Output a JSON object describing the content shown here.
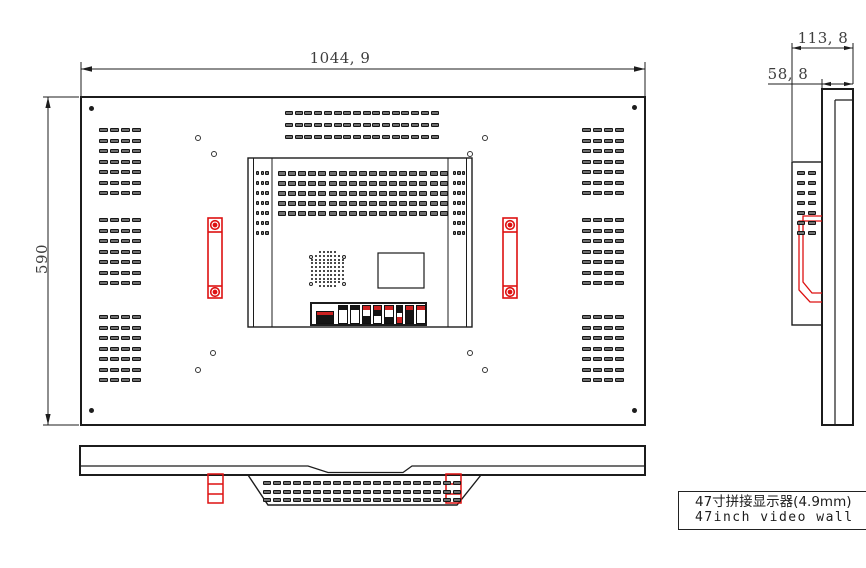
{
  "labels": {
    "dim_width": "1044, 9",
    "dim_height": "590",
    "dim_depth_total": "113, 8",
    "dim_depth_panel": "58, 8",
    "title_cn": "47寸拼接显示器(4.9mm)",
    "title_en": "47inch video wall"
  },
  "colors": {
    "line": "#1c1c1c",
    "red": "#dd1111",
    "dim_text": "#3e3e3e",
    "slot_fill": "#6f6f6f",
    "background": "#ffffff"
  },
  "slot_grids": [
    {
      "name": "rear-left-vents",
      "x": 99,
      "groupYs": [
        128,
        218,
        315
      ],
      "rows": 7,
      "cols": 4,
      "pitchX": 11,
      "pitchY": 10.5,
      "w": 9,
      "h": 4
    },
    {
      "name": "rear-right-vents",
      "x": 582,
      "groupYs": [
        128,
        218,
        315
      ],
      "rows": 7,
      "cols": 4,
      "pitchX": 11,
      "pitchY": 10.5,
      "w": 9,
      "h": 4
    },
    {
      "name": "rear-top-center-vents",
      "x": 285,
      "groupYs": [
        111
      ],
      "rows": 3,
      "cols": 16,
      "pitchX": 9.7,
      "pitchY": 12,
      "w": 8,
      "h": 4
    },
    {
      "name": "module-vent-rows",
      "x": 278,
      "groupYs": [
        171
      ],
      "rows": 5,
      "cols": 17,
      "pitchX": 10.1,
      "pitchY": 10,
      "w": 8,
      "h": 5
    },
    {
      "name": "module-strip-left",
      "x": 256,
      "groupYs": [
        171
      ],
      "rows": 7,
      "cols": 3,
      "pitchX": 4.7,
      "pitchY": 10,
      "w": 3.4,
      "h": 4
    },
    {
      "name": "module-strip-right",
      "x": 452.5,
      "groupYs": [
        171
      ],
      "rows": 7,
      "cols": 3,
      "pitchX": 4.7,
      "pitchY": 10,
      "w": 3.4,
      "h": 4
    },
    {
      "name": "side-enclosure-vents",
      "x": 797,
      "groupYs": [
        171
      ],
      "rows": 7,
      "cols": 2,
      "pitchX": 11,
      "pitchY": 10,
      "w": 8,
      "h": 4
    },
    {
      "name": "bottom-trapezoid-vents",
      "x": 263,
      "groupYs": [
        481
      ],
      "rows": 3,
      "cols": 20,
      "pitchX": 10,
      "pitchY": 8.5,
      "w": 7.5,
      "h": 4
    }
  ],
  "speaker": {
    "cx": 327.5,
    "top": 252,
    "pitch": 3.8,
    "dot": 2,
    "rowCols": [
      5,
      7,
      9,
      9,
      9,
      9,
      9,
      9,
      7,
      5
    ]
  },
  "speaker_rings": [
    [
      311,
      257
    ],
    [
      344,
      257
    ],
    [
      311,
      284
    ],
    [
      344,
      284
    ]
  ],
  "screw_dots": [
    [
      91,
      108
    ],
    [
      634,
      107
    ],
    [
      91,
      410
    ],
    [
      634,
      410
    ]
  ],
  "mount_rings": [
    [
      198,
      138
    ],
    [
      214,
      154
    ],
    [
      470,
      154
    ],
    [
      485,
      138
    ],
    [
      213,
      353
    ],
    [
      198,
      370
    ],
    [
      470,
      353
    ],
    [
      485,
      370
    ]
  ],
  "connectors": [
    {
      "x": 316,
      "y": 311,
      "w": 18,
      "segs": [
        {
          "h": 3,
          "c": "#cc2222"
        },
        {
          "h": 8,
          "c": "#151515"
        }
      ]
    },
    {
      "x": 338,
      "y": 305,
      "w": 10,
      "segs": [
        {
          "h": 4,
          "c": "#151515"
        },
        {
          "h": 13,
          "c": "#ffffff"
        }
      ]
    },
    {
      "x": 350,
      "y": 305,
      "w": 10,
      "segs": [
        {
          "h": 4,
          "c": "#151515"
        },
        {
          "h": 13,
          "c": "#ffffff"
        }
      ]
    },
    {
      "x": 362,
      "y": 305,
      "w": 9,
      "segs": [
        {
          "h": 4,
          "c": "#cc2222"
        },
        {
          "h": 6,
          "c": "#ffffff"
        },
        {
          "h": 7,
          "c": "#151515"
        }
      ]
    },
    {
      "x": 373,
      "y": 305,
      "w": 9,
      "segs": [
        {
          "h": 4,
          "c": "#cc2222"
        },
        {
          "h": 6,
          "c": "#151515"
        },
        {
          "h": 7,
          "c": "#ffffff"
        }
      ]
    },
    {
      "x": 384,
      "y": 305,
      "w": 10,
      "segs": [
        {
          "h": 4,
          "c": "#cc2222"
        },
        {
          "h": 7,
          "c": "#ffffff"
        },
        {
          "h": 6,
          "c": "#151515"
        }
      ]
    },
    {
      "x": 396,
      "y": 305,
      "w": 7,
      "segs": [
        {
          "h": 7,
          "c": "#151515"
        },
        {
          "h": 4,
          "c": "#ffffff"
        },
        {
          "h": 6,
          "c": "#cc2222"
        }
      ]
    },
    {
      "x": 405,
      "y": 305,
      "w": 9,
      "segs": [
        {
          "h": 4,
          "c": "#cc2222"
        },
        {
          "h": 13,
          "c": "#151515"
        }
      ]
    },
    {
      "x": 416,
      "y": 305,
      "w": 10,
      "segs": [
        {
          "h": 4,
          "c": "#cc2222"
        },
        {
          "h": 13,
          "c": "#ffffff"
        }
      ]
    }
  ]
}
